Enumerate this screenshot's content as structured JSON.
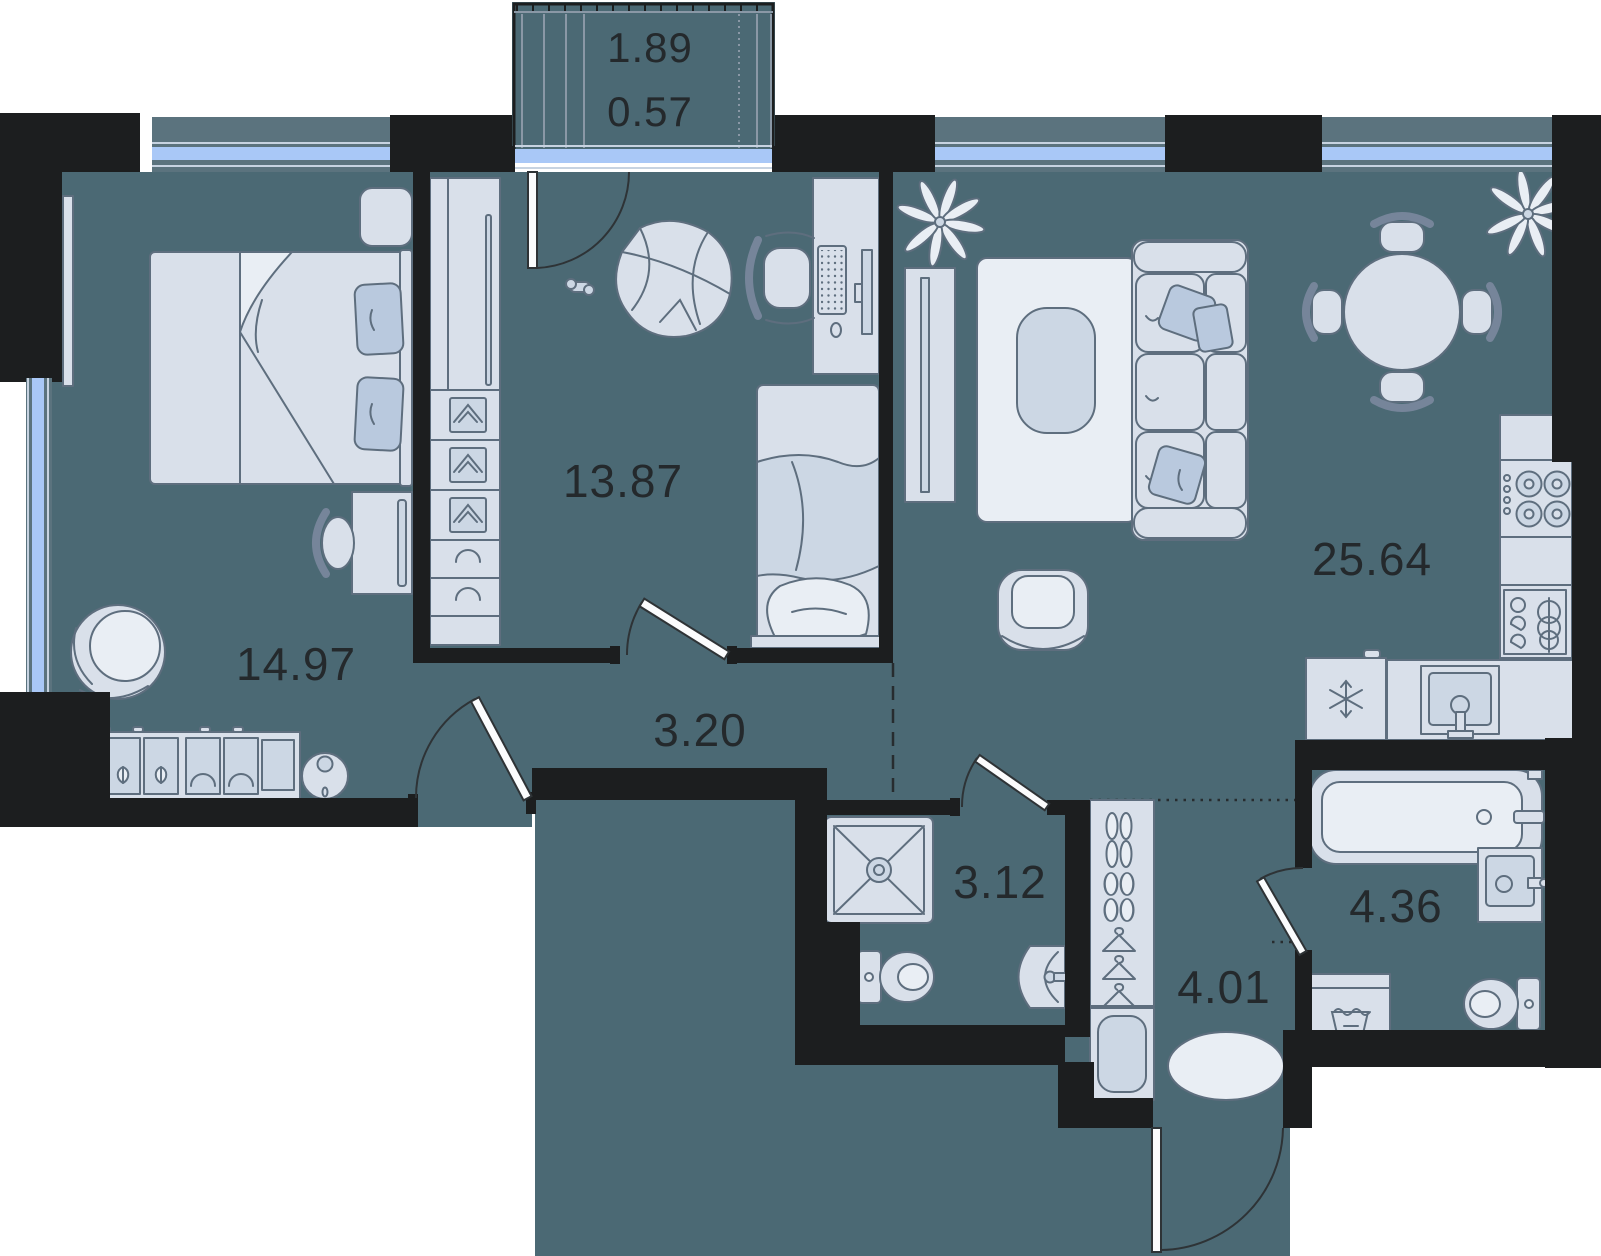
{
  "plan": {
    "type": "apartment-floor-plan",
    "colors": {
      "floor": "#4b6974",
      "walls": "#1c1e1f",
      "furniture_fill": "#d9e0ea",
      "furniture_stroke": "#5e6e7e",
      "window_glass": "#a9c8f7",
      "label_text": "#24292c",
      "background": "#ffffff"
    },
    "rooms": [
      {
        "id": "balcony",
        "area_top": "1.89",
        "area_bottom": "0.57",
        "furniture": [
          "glazed-railing"
        ]
      },
      {
        "id": "bedroom",
        "area": "14.97",
        "furniture": [
          "double-bed",
          "pillows",
          "nightstand",
          "wall-tv",
          "desk",
          "chair",
          "egg-chair",
          "dresser",
          "robot-vacuum",
          "window"
        ]
      },
      {
        "id": "study-bedroom",
        "area": "13.87",
        "furniture": [
          "wardrobe-with-shelves",
          "bean-bag",
          "game-controller",
          "desk",
          "monitor",
          "keyboard",
          "mouse",
          "office-chair",
          "single-bed"
        ]
      },
      {
        "id": "living-room-kitchen",
        "area": "25.64",
        "furniture": [
          "plant",
          "tv-stand",
          "tv",
          "rug",
          "coffee-table",
          "sofa",
          "pillows",
          "armchair",
          "round-dining-table",
          "four-chairs",
          "plant",
          "stove-4-burners",
          "kitchen-counter",
          "dish-rack",
          "fridge",
          "kitchen-sink"
        ]
      },
      {
        "id": "hallway",
        "area": "3.20",
        "furniture": []
      },
      {
        "id": "shower-room",
        "area": "3.12",
        "furniture": [
          "shower-tray",
          "toilet",
          "wall-sink"
        ]
      },
      {
        "id": "entry-hall",
        "area": "4.01",
        "furniture": [
          "shoe-wardrobe",
          "hangers",
          "bench",
          "oval-rug",
          "entrance-door"
        ]
      },
      {
        "id": "bathroom",
        "area": "4.36",
        "furniture": [
          "bathtub",
          "sink",
          "washing-machine",
          "toilet"
        ]
      }
    ]
  }
}
